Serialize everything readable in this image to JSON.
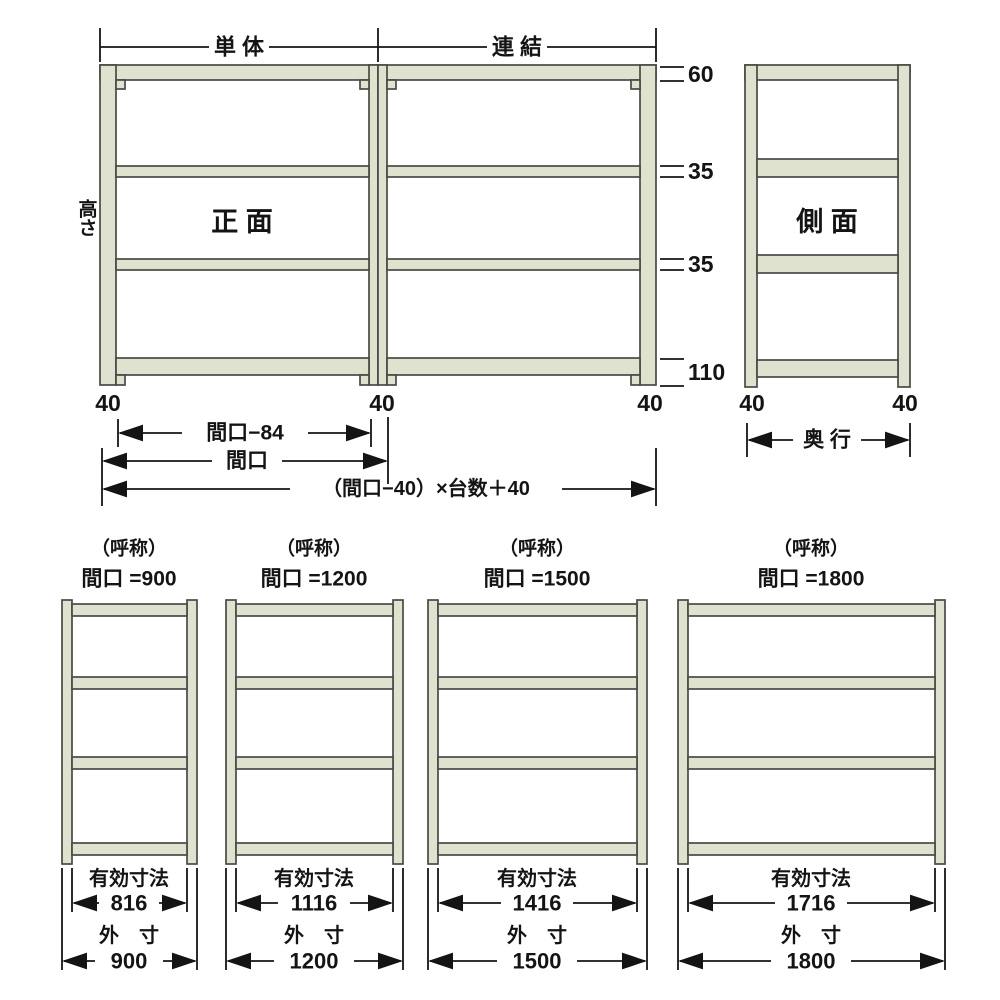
{
  "diagram": {
    "unit_bar": {
      "single": "単 体",
      "linked": "連 結"
    },
    "front": {
      "title": "正 面",
      "height_label": "高さ",
      "right_dims": [
        "60",
        "35",
        "35",
        "110"
      ],
      "post_widths": [
        "40",
        "40",
        "40"
      ],
      "dim_inner": "間口−84",
      "dim_width": "間口",
      "dim_formula": "（間口−40）×台数＋40"
    },
    "side": {
      "title": "側 面",
      "post_widths": [
        "40",
        "40"
      ],
      "dim_depth": "奥 行"
    },
    "variants": [
      {
        "caption": "（呼称）",
        "title": "間口 =900",
        "eff_label": "有効寸法",
        "eff_value": "816",
        "out_label": "外　寸",
        "out_value": "900"
      },
      {
        "caption": "（呼称）",
        "title": "間口 =1200",
        "eff_label": "有効寸法",
        "eff_value": "1116",
        "out_label": "外　寸",
        "out_value": "1200"
      },
      {
        "caption": "（呼称）",
        "title": "間口 =1500",
        "eff_label": "有効寸法",
        "eff_value": "1416",
        "out_label": "外　寸",
        "out_value": "1500"
      },
      {
        "caption": "（呼称）",
        "title": "間口 =1800",
        "eff_label": "有効寸法",
        "eff_value": "1716",
        "out_label": "外　寸",
        "out_value": "1800"
      }
    ],
    "colors": {
      "steel": "#dfe2cf",
      "frame": "#4a4a45",
      "ink": "#141414"
    }
  }
}
